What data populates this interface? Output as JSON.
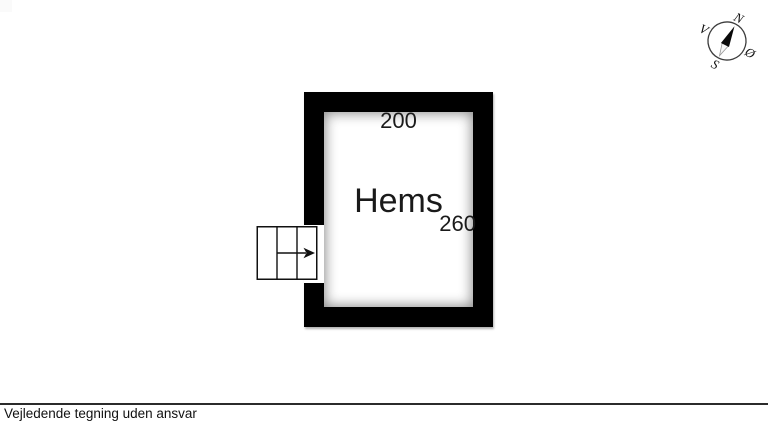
{
  "colors": {
    "wall": "#000000",
    "line": "#111111",
    "background": "#ffffff"
  },
  "plan": {
    "room_label": "Hems",
    "top_dimension": "200",
    "right_dimension": "260"
  },
  "compass": {
    "north": "N",
    "west": "V",
    "east": "Ø",
    "south": "S"
  },
  "footer": {
    "disclaimer": "Vejledende tegning uden ansvar"
  }
}
